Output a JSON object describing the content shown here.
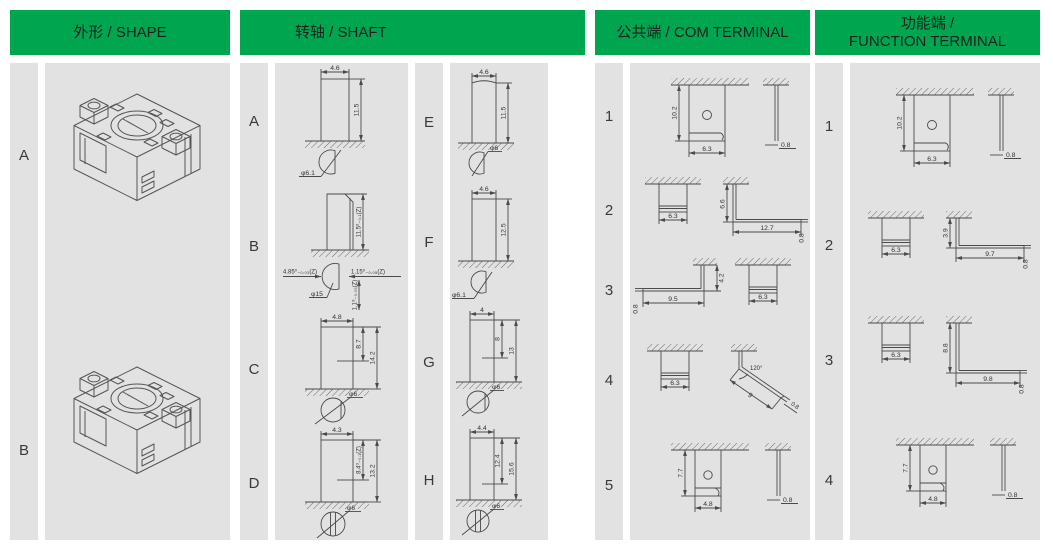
{
  "headers": {
    "shape": "外形 / SHAPE",
    "shaft": "转轴 / SHAFT",
    "com": "公共端 / COM TERMINAL",
    "function_zh": "功能端 /",
    "function_en": "FUNCTION TERMINAL"
  },
  "colors": {
    "header_bg": "#00A550",
    "panel_bg": "#E2E2E2",
    "line": "#4A4A4A"
  },
  "shape": {
    "rows": [
      {
        "label": "A"
      },
      {
        "label": "B"
      }
    ]
  },
  "shaft": {
    "items_left": [
      {
        "label": "A",
        "w": "4.6",
        "h": "11.5",
        "dia": "φ6.1"
      },
      {
        "label": "B",
        "h": "11.5⁰₋₀.₁(Z)",
        "left": "4.85⁰₋₀.₀₃(Z)",
        "right": "1.15⁰₋₀.₀₅(Z)",
        "dia": "φ15",
        "bottom": "1.1⁰₋₀.₀₅(Z)"
      },
      {
        "label": "C",
        "w": "4.8",
        "h1": "8.7",
        "h2": "14.2",
        "dia": "φ6"
      },
      {
        "label": "D",
        "w": "4.3",
        "h1": "8.4⁰₋₀.₁(Z)",
        "h2": "13.2",
        "dia": "φ6"
      }
    ],
    "items_right": [
      {
        "label": "E",
        "w": "4.6",
        "h": "11.5",
        "dia": "φ6"
      },
      {
        "label": "F",
        "w": "4.6",
        "h": "12.5",
        "dia": "φ6.1"
      },
      {
        "label": "G",
        "w": "4",
        "h1": "8",
        "h2": "13",
        "dia": "φ6"
      },
      {
        "label": "H",
        "w": "4.4",
        "h1": "12.4",
        "h2": "15.6",
        "dia": "φ6"
      }
    ]
  },
  "com": {
    "items": [
      {
        "label": "1",
        "h": "10.2",
        "w": "6.3",
        "t": "0.8"
      },
      {
        "label": "2",
        "w": "6.3",
        "side_h": "6.6",
        "side_l": "12.7",
        "t": "0.8"
      },
      {
        "label": "3",
        "t": "0.8",
        "side_l": "9.5",
        "side_h": "4.2",
        "w": "6.3"
      },
      {
        "label": "4",
        "w": "6.3",
        "angle": "120°",
        "side_l": "9",
        "t": "0.8"
      },
      {
        "label": "5",
        "h": "7.7",
        "w": "4.8",
        "t": "0.8"
      }
    ]
  },
  "fn": {
    "items": [
      {
        "label": "1",
        "h": "10.2",
        "w": "6.3",
        "t": "0.8"
      },
      {
        "label": "2",
        "w": "6.3",
        "side_h": "3.9",
        "side_l": "9.7",
        "t": "0.8"
      },
      {
        "label": "3",
        "w": "6.3",
        "side_h": "8.8",
        "side_l": "9.8",
        "t": "0.8"
      },
      {
        "label": "4",
        "h": "7.7",
        "w": "4.8",
        "t": "0.8"
      }
    ]
  }
}
